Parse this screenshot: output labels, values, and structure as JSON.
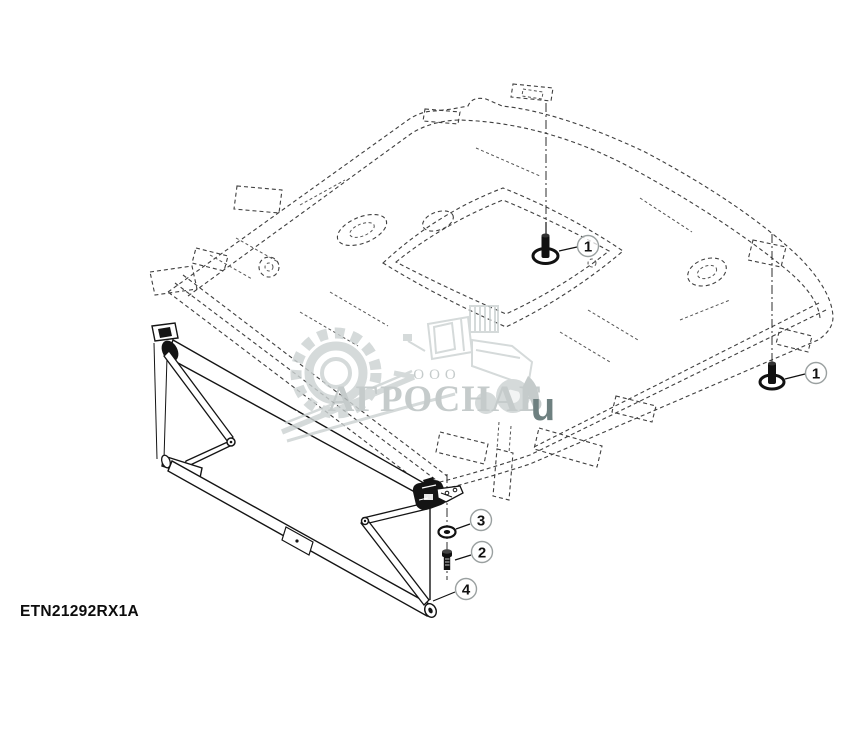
{
  "diagram": {
    "part_code": "ETN21292RX1A",
    "description": "Sunshade roller assembly mounted under cab roof (exploded parts view)",
    "callouts": [
      {
        "id": "1a",
        "label": "1",
        "part": "mounting-screw-left"
      },
      {
        "id": "1b",
        "label": "1",
        "part": "mounting-screw-right"
      },
      {
        "id": "3",
        "label": "3",
        "part": "washer"
      },
      {
        "id": "2",
        "label": "2",
        "part": "bolt"
      },
      {
        "id": "4",
        "label": "4",
        "part": "sunshade-frame"
      }
    ],
    "colors": {
      "solid_line": "#141414",
      "phantom_line": "#3f3f3f",
      "callout_ring": "#9aa0a0"
    }
  },
  "watermark": {
    "org_type": "ООО",
    "company": "АГРОСНАБ",
    "suffix_letter": "u",
    "colors": {
      "graphic": "#ccd2d2",
      "text": "#b9c0c0",
      "letter": "#6e8080"
    }
  }
}
